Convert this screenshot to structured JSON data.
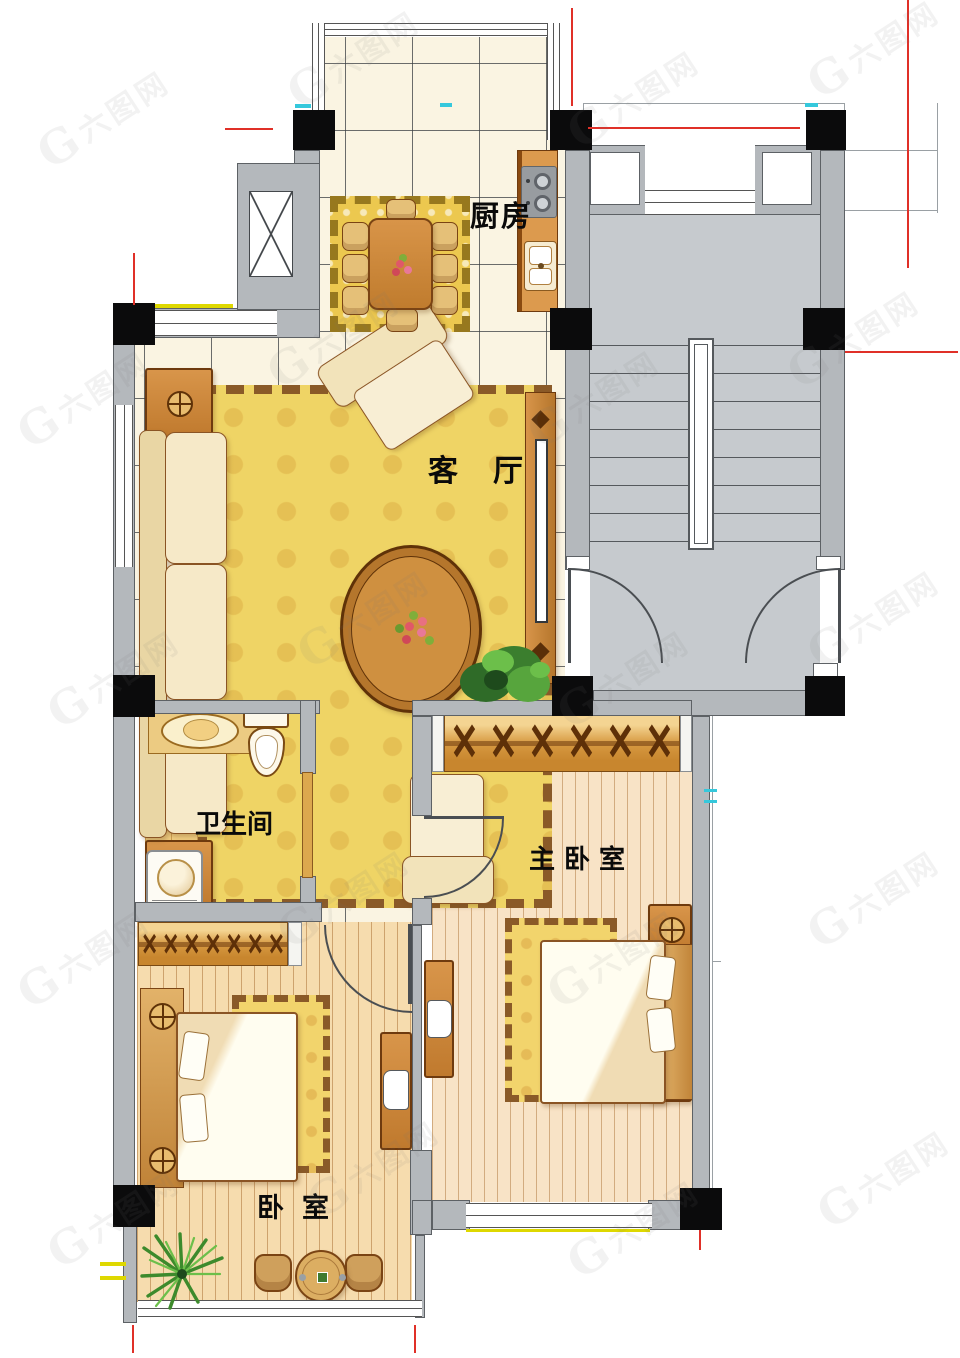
{
  "rooms": {
    "kitchen": {
      "label": "厨房"
    },
    "living_room": {
      "label": "客厅"
    },
    "bathroom": {
      "label": "卫生间"
    },
    "master_bedroom": {
      "label": "主卧室"
    },
    "bedroom": {
      "label": "卧室"
    }
  },
  "watermark": {
    "monogram": "G",
    "label": "六图网"
  },
  "colors": {
    "wall_gray": "#b4b8bc",
    "stair_gray": "#c6cace",
    "column_black": "#0b0b0c",
    "tile_floor": "#faf4e2",
    "bath_floor": "#f2cf82",
    "wood_floor": "#f6dcae",
    "furniture_wood": "#c8812f",
    "upholstery": "#f6e9c8",
    "rug_yellow": "#efd465",
    "dimension_red": "#e03028",
    "mark_cyan": "#35c8dc",
    "mark_yellow": "#ded800"
  }
}
